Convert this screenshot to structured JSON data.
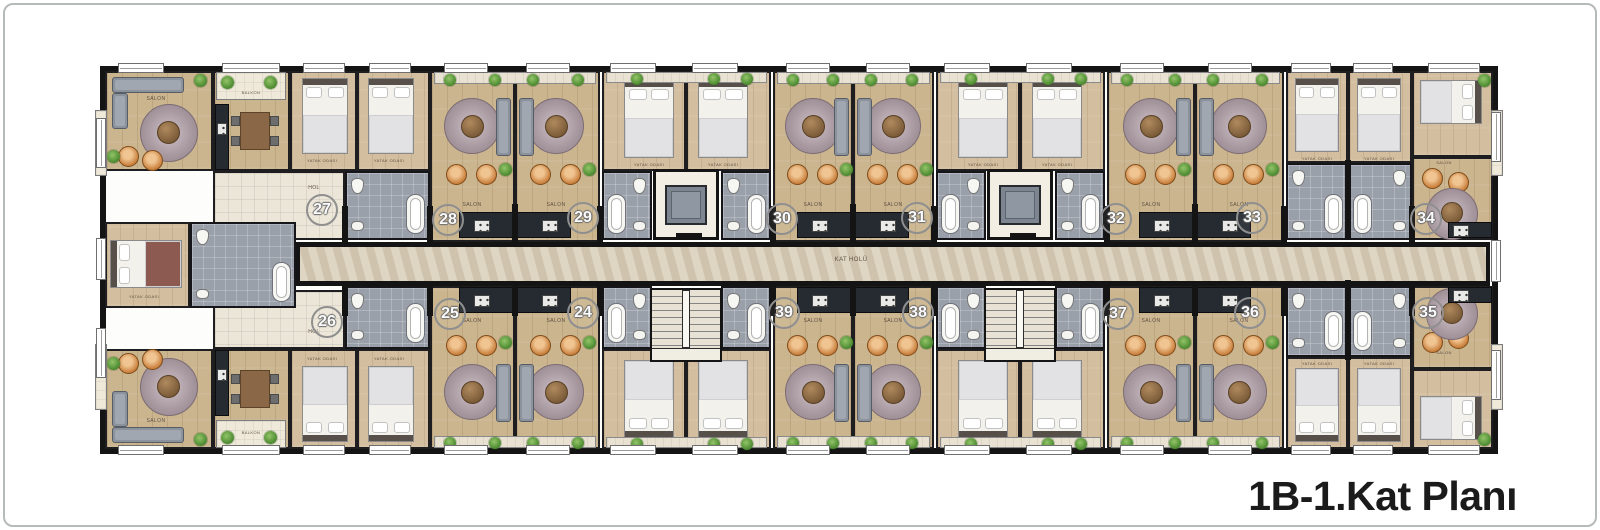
{
  "title": "1B-1.Kat Planı",
  "plan": {
    "units_top": [
      "27",
      "28",
      "29",
      "30",
      "31",
      "32",
      "33",
      "34"
    ],
    "units_bottom": [
      "26",
      "25",
      "24",
      "39",
      "38",
      "37",
      "36",
      "35"
    ]
  },
  "labels": {
    "corridor": "KAT HOLÜ",
    "hall": "HOL",
    "salon": "SALON",
    "bedroom": "YATAK ODASI",
    "balcony": "BALKON",
    "kitchen": "MUTFAK",
    "bath": "BANYO"
  },
  "colors": {
    "wall": "#141414",
    "wood_floor": "#cbb58f",
    "corridor_floor": "#d8cdb8",
    "bath_tile": "#9aa0aa",
    "kitchen_counter": "#262b31",
    "rattan_chair": "#ca803d",
    "plant": "#4f8d33",
    "rug": "#a99aa1",
    "badge_ring": "#8f8f8f",
    "title_text": "#1b1b1b"
  }
}
